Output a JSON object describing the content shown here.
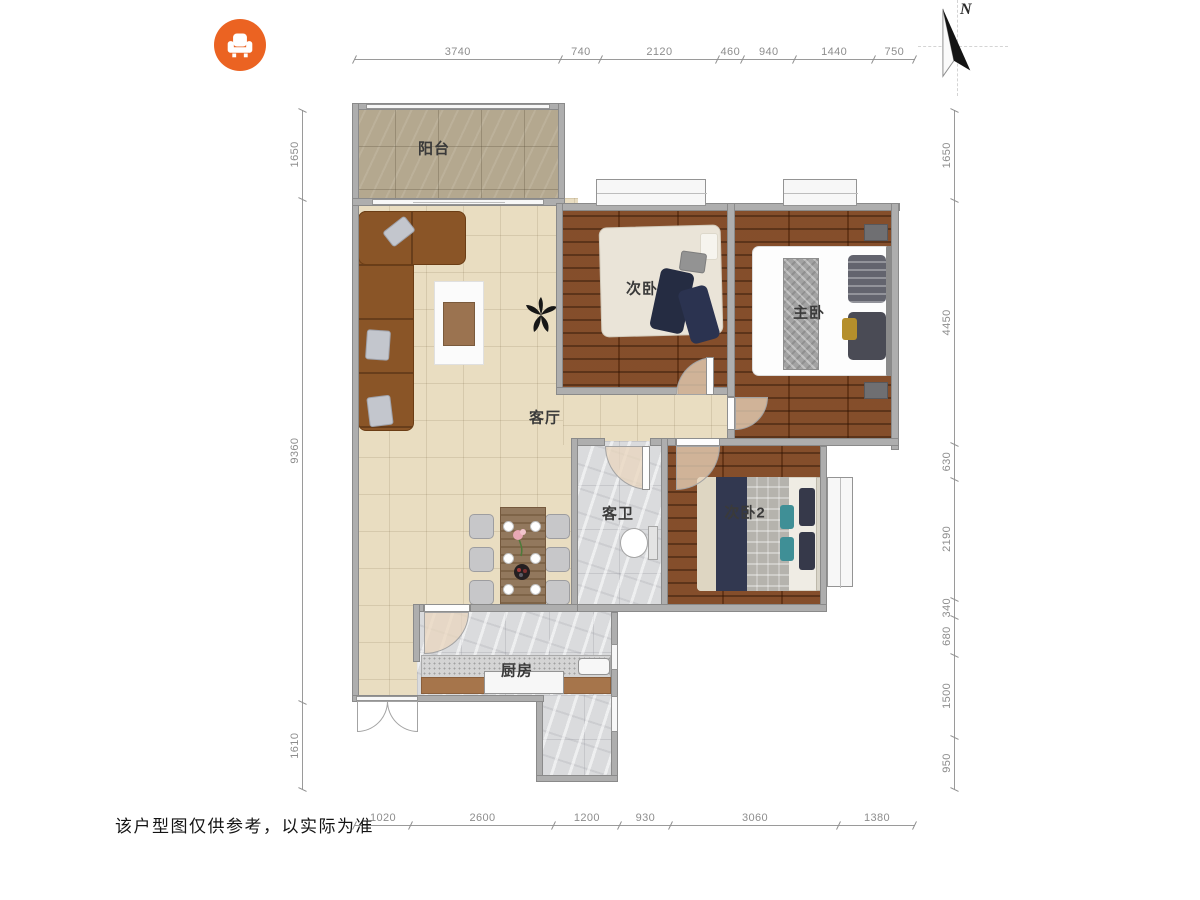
{
  "logo": {
    "icon": "sofa-icon",
    "color": "#eb6322"
  },
  "compass": {
    "label": "N"
  },
  "rooms": {
    "balcony": "阳台",
    "living_room": "客厅",
    "bedroom_2": "次卧",
    "master_bedroom": "主卧",
    "guest_bathroom": "客卫",
    "bedroom_3": "次卧2",
    "kitchen": "厨房"
  },
  "dimensions_mm": {
    "top": [
      3740,
      740,
      2120,
      460,
      940,
      1440,
      750
    ],
    "bottom": [
      1020,
      2600,
      1200,
      930,
      3060,
      1380
    ],
    "left": [
      1650,
      9360,
      1610
    ],
    "right": [
      1650,
      4450,
      630,
      2190,
      340,
      680,
      1500,
      950
    ]
  },
  "disclaimer": "该户型图仅供参考，以实际为准",
  "palette": {
    "wall": "#aeaeae",
    "wood_floor": "#7d431e",
    "tile_floor": "#e9ddc1",
    "marble_floor": "#dadbdd",
    "balcony_floor": "#b4a88f",
    "accent_orange": "#eb6322"
  }
}
